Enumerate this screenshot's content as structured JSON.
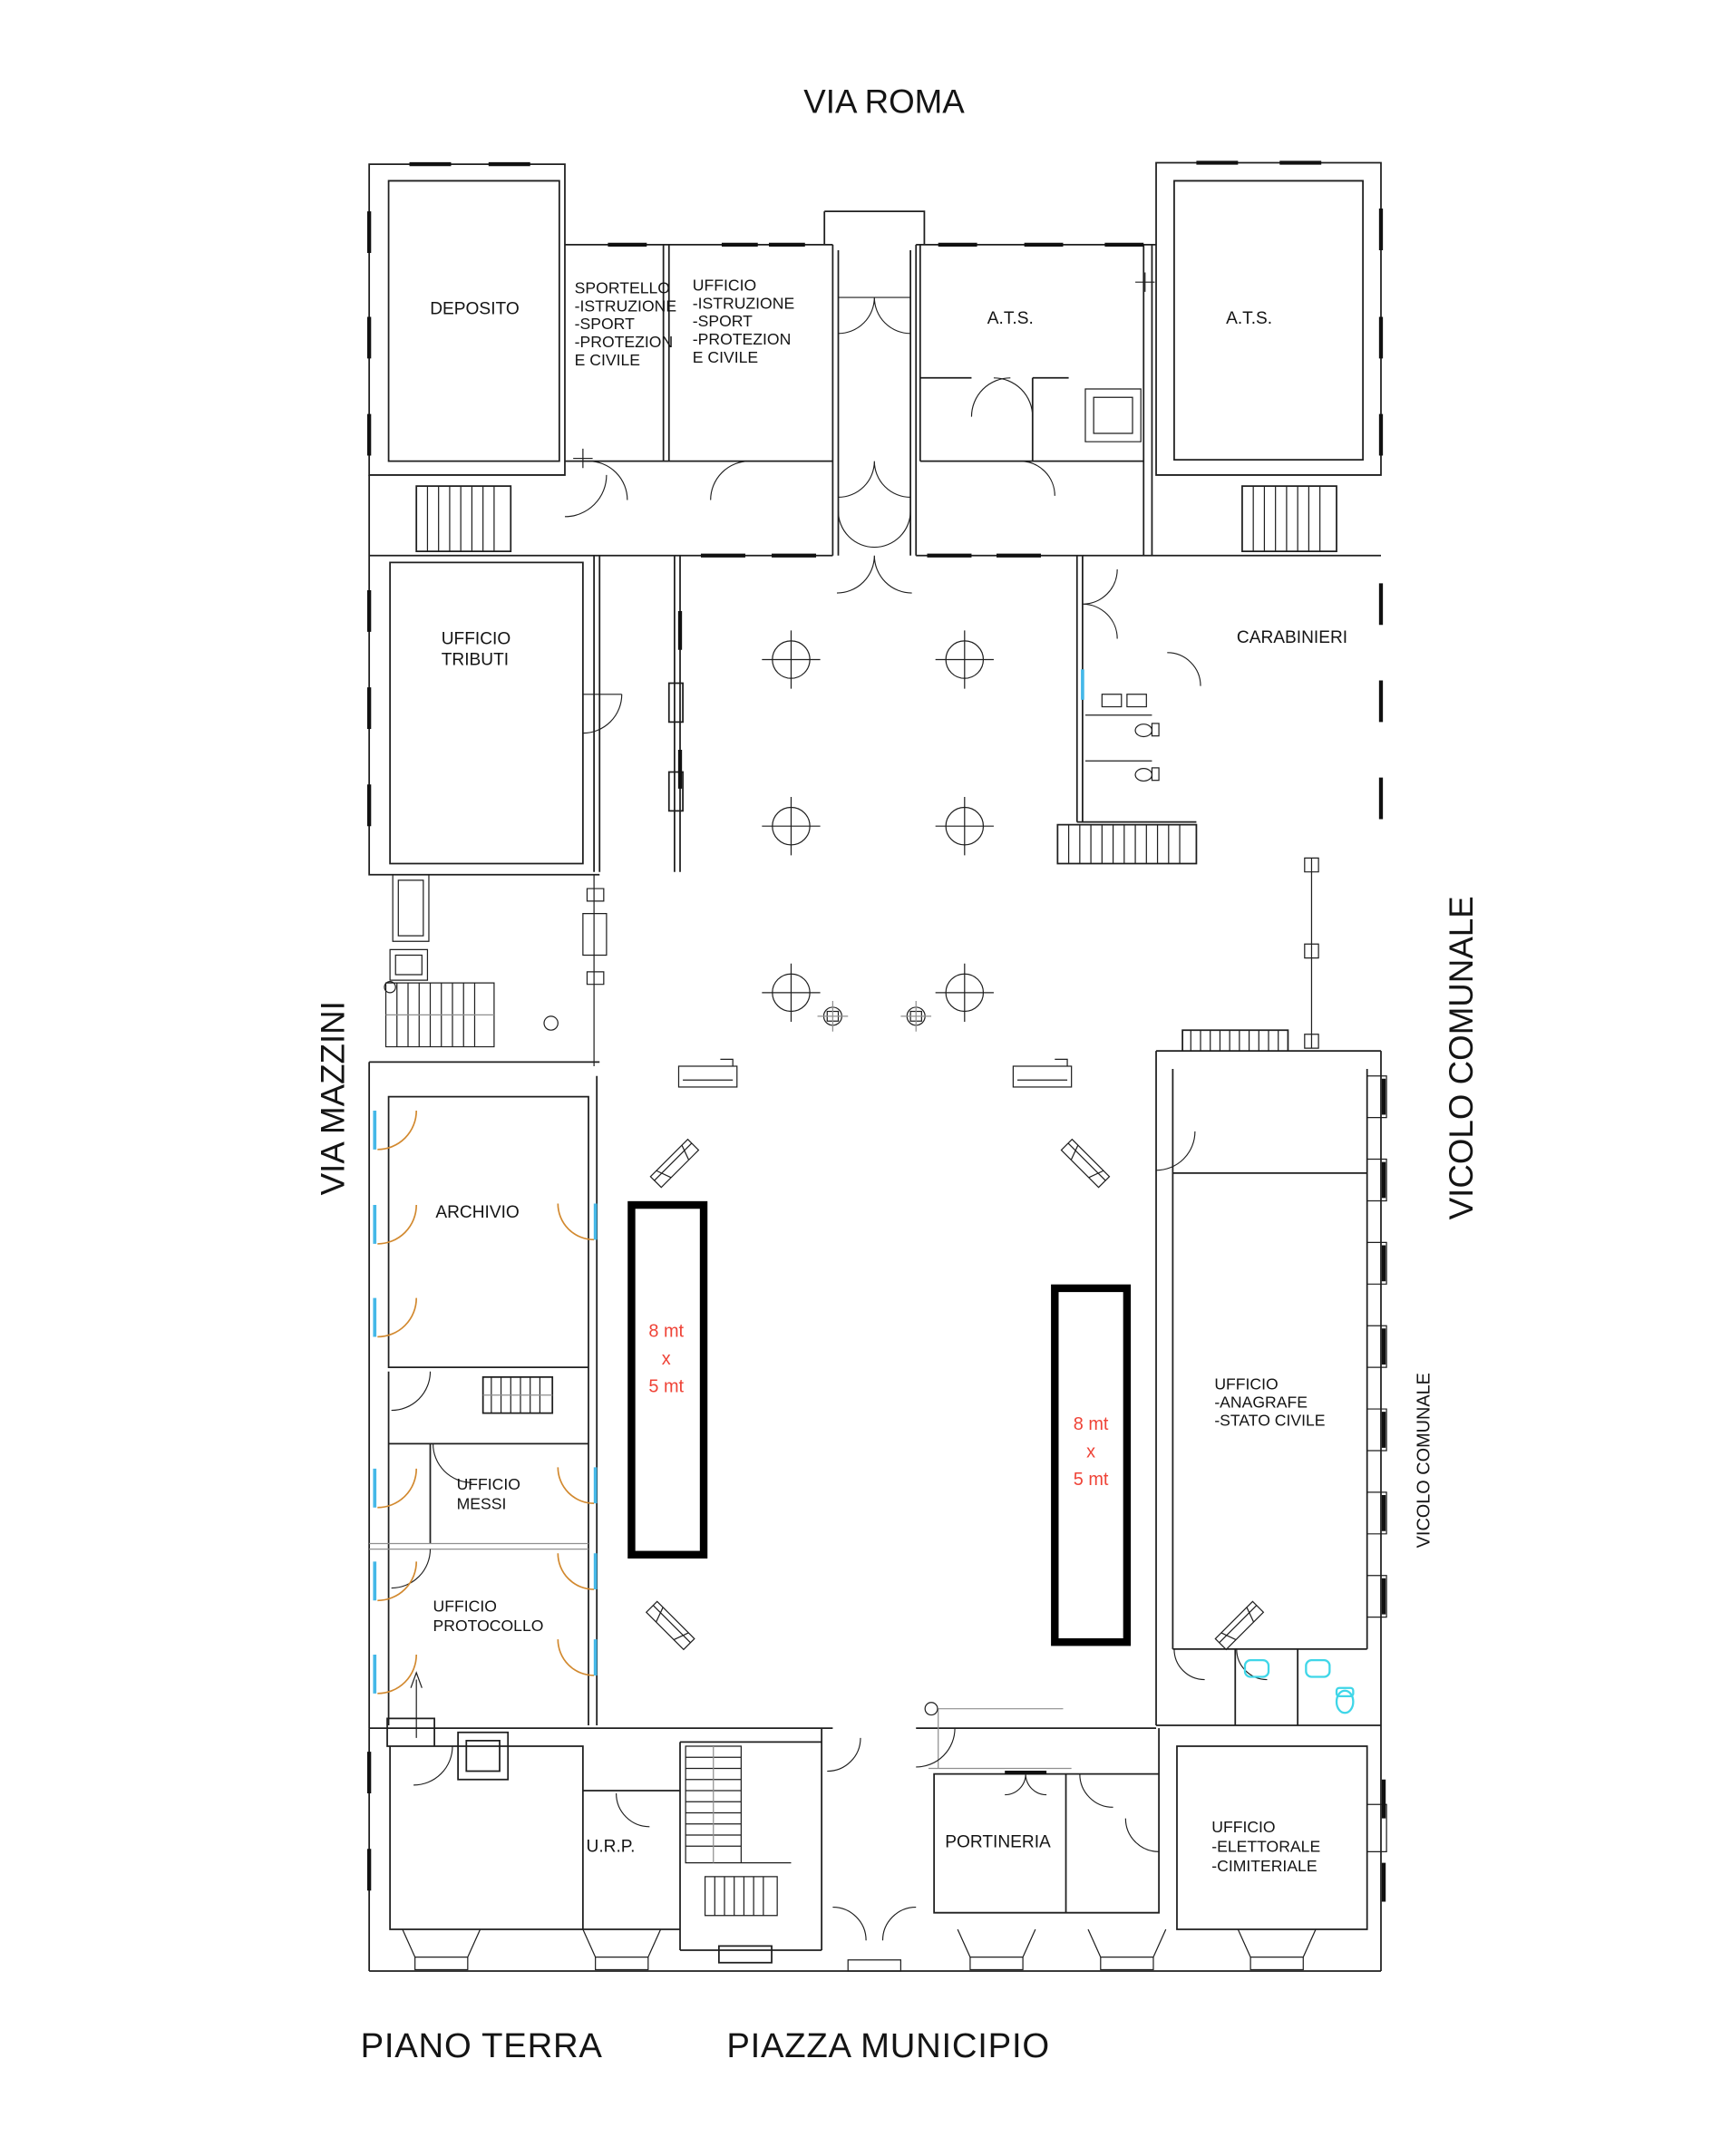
{
  "streets": {
    "top": "VIA ROMA",
    "left": "VIA MAZZINI",
    "right_large": "VICOLO COMUNALE",
    "right_small": "VICOLO COMUNALE"
  },
  "footer": {
    "floor": "PIANO TERRA",
    "square": "PIAZZA MUNICIPIO"
  },
  "rooms": {
    "deposito": {
      "label": "DEPOSITO"
    },
    "sportello": {
      "lines": [
        "SPORTELLO",
        "-ISTRUZIONE",
        "-SPORT",
        "-PROTEZION",
        "E CIVILE"
      ]
    },
    "istruzione": {
      "lines": [
        "UFFICIO",
        "-ISTRUZIONE",
        "-SPORT",
        "-PROTEZION",
        "E CIVILE"
      ]
    },
    "ats_west": {
      "label": "A.T.S."
    },
    "ats_east": {
      "label": "A.T.S."
    },
    "tributi": {
      "lines": [
        "UFFICIO",
        "TRIBUTI"
      ]
    },
    "carabinieri": {
      "label": "CARABINIERI"
    },
    "archivio": {
      "label": "ARCHIVIO"
    },
    "messi": {
      "lines": [
        "UFFICIO",
        "MESSI"
      ]
    },
    "protocollo": {
      "lines": [
        "UFFICIO",
        "PROTOCOLLO"
      ]
    },
    "urp": {
      "label": "U.R.P."
    },
    "portineria": {
      "label": "PORTINERIA"
    },
    "elettorale": {
      "lines": [
        "UFFICIO",
        "-ELETTORALE",
        "-CIMITERIALE"
      ]
    },
    "anagrafe": {
      "lines": [
        "UFFICIO",
        "-ANAGRAFE",
        "-STATO CIVILE"
      ]
    }
  },
  "zones": {
    "west": {
      "lines": [
        "8 mt",
        "x",
        "5 mt"
      ]
    },
    "east": {
      "lines": [
        "8 mt",
        "x",
        "5 mt"
      ]
    }
  },
  "colors": {
    "wall": "#1f1f1f",
    "secondary_gray": "#8f8f8f",
    "zone_text_red": "#ef4337",
    "door_swing_orange": "#d2892f",
    "glazing_blue": "#45b8e8",
    "fixture_cyan": "#3fd6e8",
    "zone_border": "#000000"
  }
}
